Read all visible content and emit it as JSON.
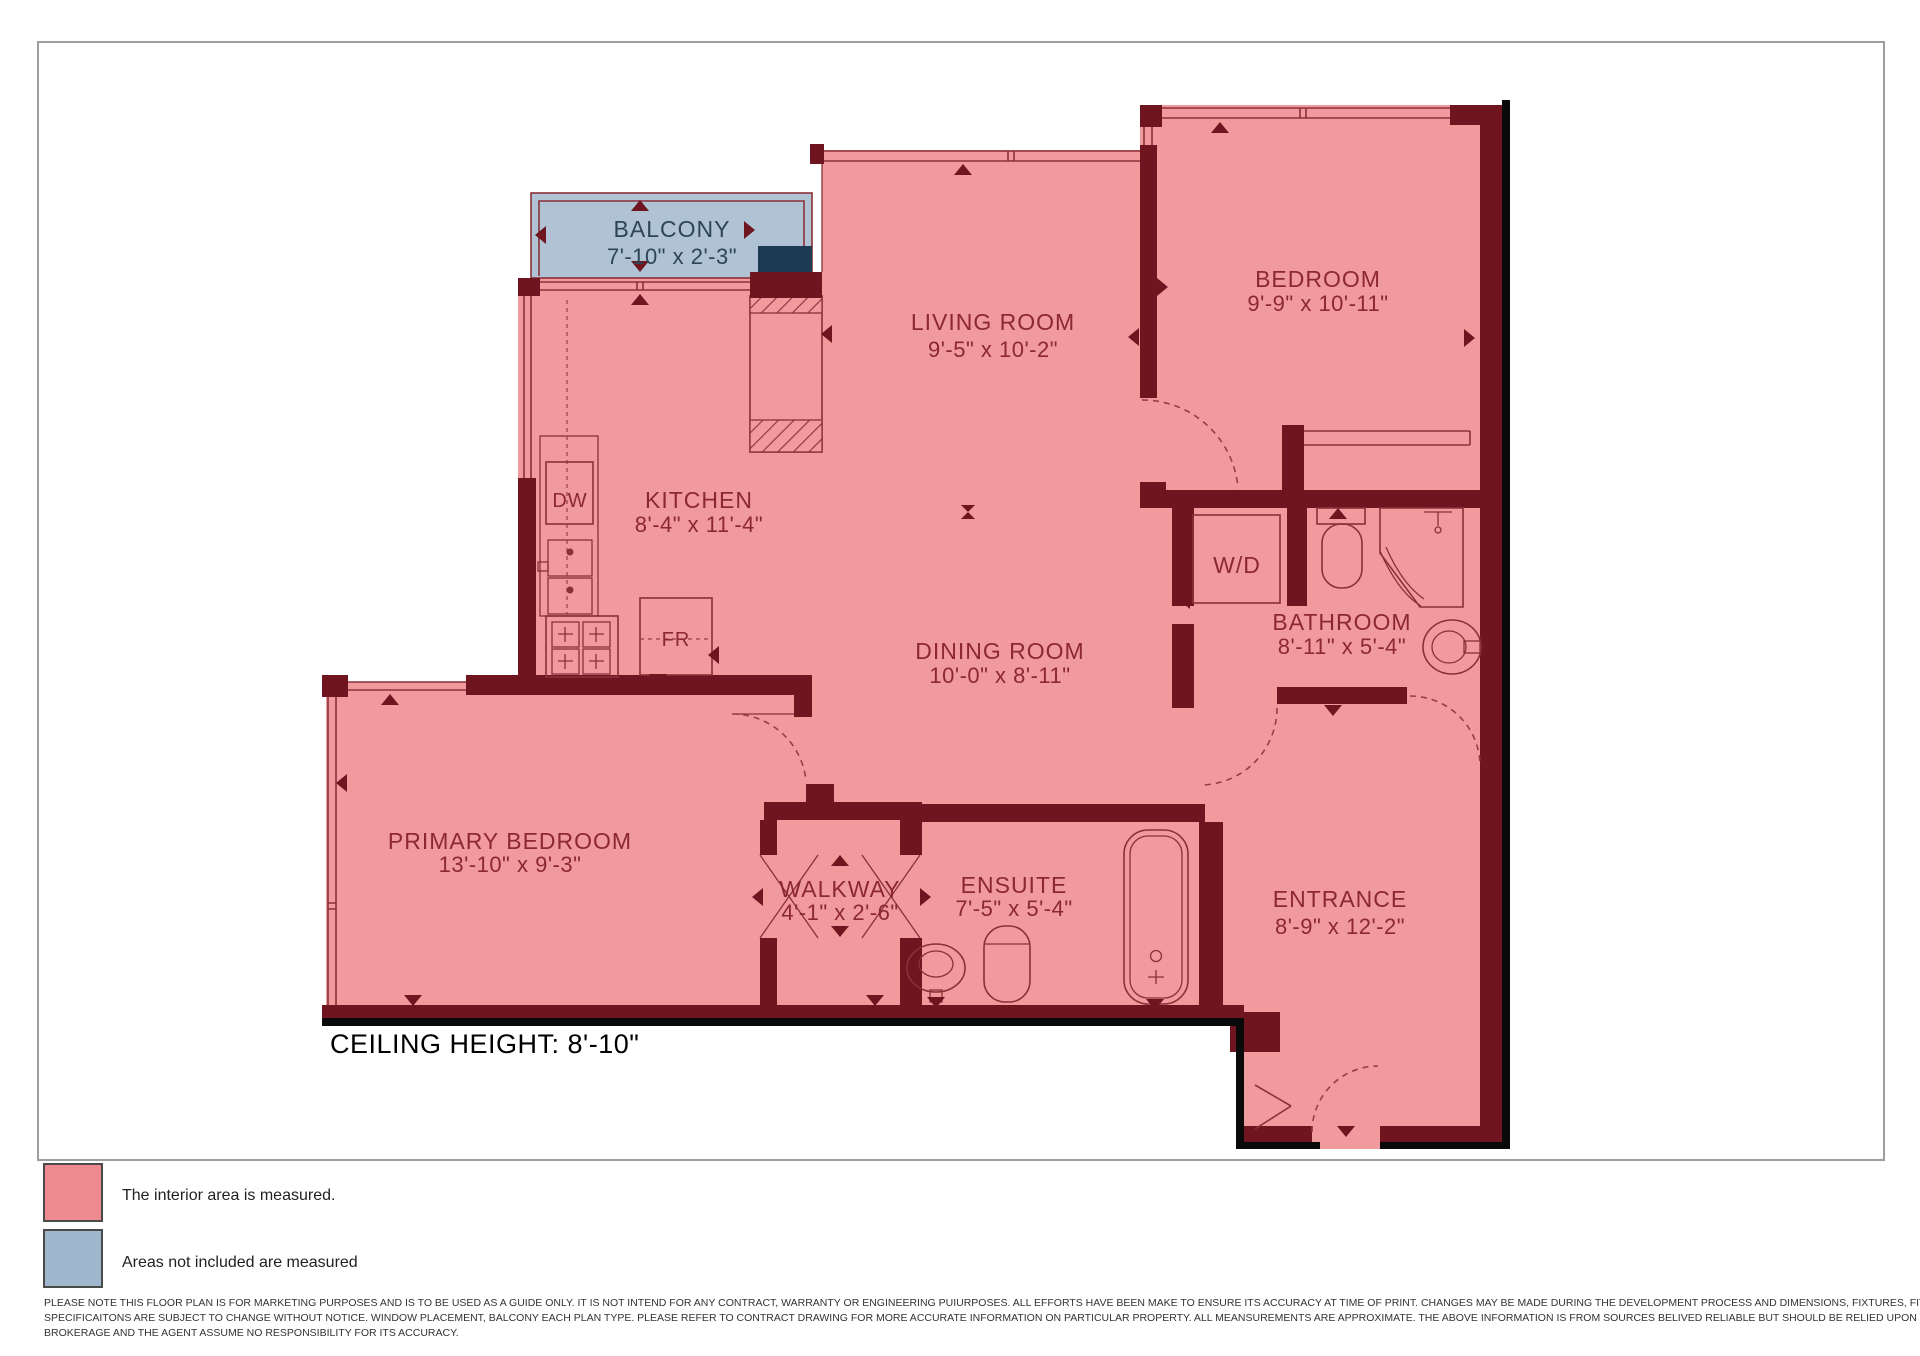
{
  "page": {
    "ceiling_height": "CEILING HEIGHT: 8'-10\""
  },
  "rooms": {
    "balcony": {
      "label": "BALCONY",
      "dims": "7'-10\" x 2'-3\""
    },
    "living_room": {
      "label": "LIVING ROOM",
      "dims": "9'-5\" x 10'-2\""
    },
    "bedroom": {
      "label": "BEDROOM",
      "dims": "9'-9\" x 10'-11\""
    },
    "kitchen": {
      "label": "KITCHEN",
      "dims": "8'-4\" x 11'-4\""
    },
    "dining_room": {
      "label": "DINING ROOM",
      "dims": "10'-0\" x 8'-11\""
    },
    "bathroom": {
      "label": "BATHROOM",
      "dims": "8'-11\" x 5'-4\""
    },
    "washer_dryer": {
      "label": "W/D"
    },
    "primary_bedroom": {
      "label": "PRIMARY BEDROOM",
      "dims": "13'-10\" x 9'-3\""
    },
    "walkway": {
      "label": "WALKWAY",
      "dims": "4'-1\" x 2'-6\""
    },
    "ensuite": {
      "label": "ENSUITE",
      "dims": "7'-5\" x 5'-4\""
    },
    "entrance": {
      "label": "ENTRANCE",
      "dims": "8'-9\" x 12'-2\""
    }
  },
  "appliances": {
    "dishwasher": "DW",
    "fridge": "FR"
  },
  "legend": {
    "interior": {
      "label": "The interior area is measured.",
      "color": "#EC8A90"
    },
    "excluded": {
      "label": "Areas not included are measured",
      "color": "#9FB7CC"
    }
  },
  "disclaimer": {
    "line1": "PLEASE NOTE THIS FLOOR PLAN IS FOR MARKETING PURPOSES AND IS TO BE USED AS A GUIDE ONLY. IT IS NOT INTEND FOR ANY CONTRACT, WARRANTY OR ENGINEERING PUIURPOSES. ALL EFFORTS HAVE BEEN MAKE TO ENSURE ITS ACCURACY AT TIME OF PRINT. CHANGES MAY BE MADE DURING THE DEVELOPMENT PROCESS AND DIMENSIONS, FIXTURES, FITTINGS, DINISHES AND",
    "line2": "SPECIFICAITONS ARE SUBJECT TO CHANGE WITHOUT NOTICE. WINDOW PLACEMENT, BALCONY EACH PLAN TYPE. PLEASE REFER TO CONTRACT DRAWING FOR MORE ACCURATE INFORMATION ON PARTICULAR PROPERTY. ALL MEANSUREMENTS ARE APPROXIMATE. THE ABOVE INFORMATION IS FROM SOURCES BELIVED RELIABLE BUT SHOULD BE RELIED UPON WITHOUT VERIFICATION. THE",
    "line3": "BROKERAGE AND THE AGENT ASSUME NO RESPONSIBILITY FOR ITS ACCURACY."
  },
  "colors": {
    "interior_fill": "#F09A9E",
    "wall": "#6E1520",
    "balcony_fill": "#AFC3D4",
    "column": "#1C3B52",
    "outline": "#0A0A0A",
    "label_text": "#8D2830"
  }
}
